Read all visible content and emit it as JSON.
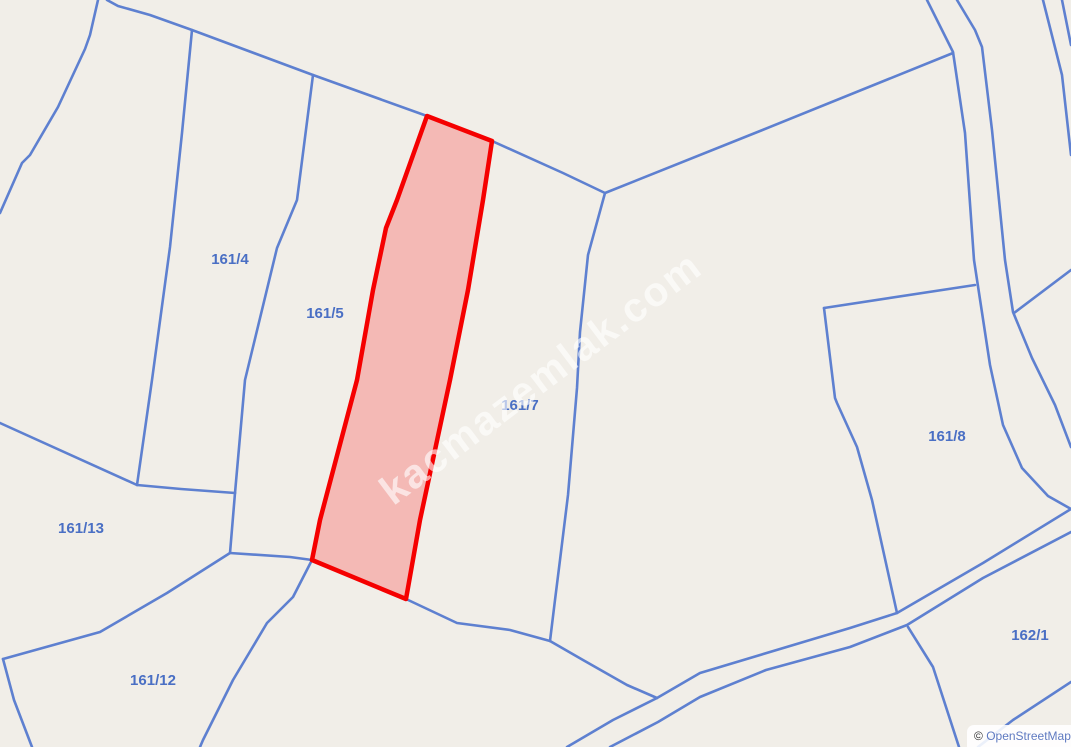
{
  "map": {
    "background_color": "#f1eee8",
    "boundary_color": "#5e80d0",
    "label_color": "#4a6fc4",
    "parcels": [
      {
        "label": "161/4"
      },
      {
        "label": "161/5"
      },
      {
        "label": "161/7"
      },
      {
        "label": "161/8"
      },
      {
        "label": "161/13"
      },
      {
        "label": "161/12"
      },
      {
        "label": "162/1"
      }
    ],
    "highlighted_parcel": {
      "stroke_color": "#f50000",
      "fill_color": "rgba(255,0,0,0.22)"
    }
  },
  "watermark": {
    "text": "kacmazemlak.com",
    "color": "#ffffff"
  },
  "attribution": {
    "copyright_symbol": "© ",
    "link_text": "OpenStreetMap"
  }
}
